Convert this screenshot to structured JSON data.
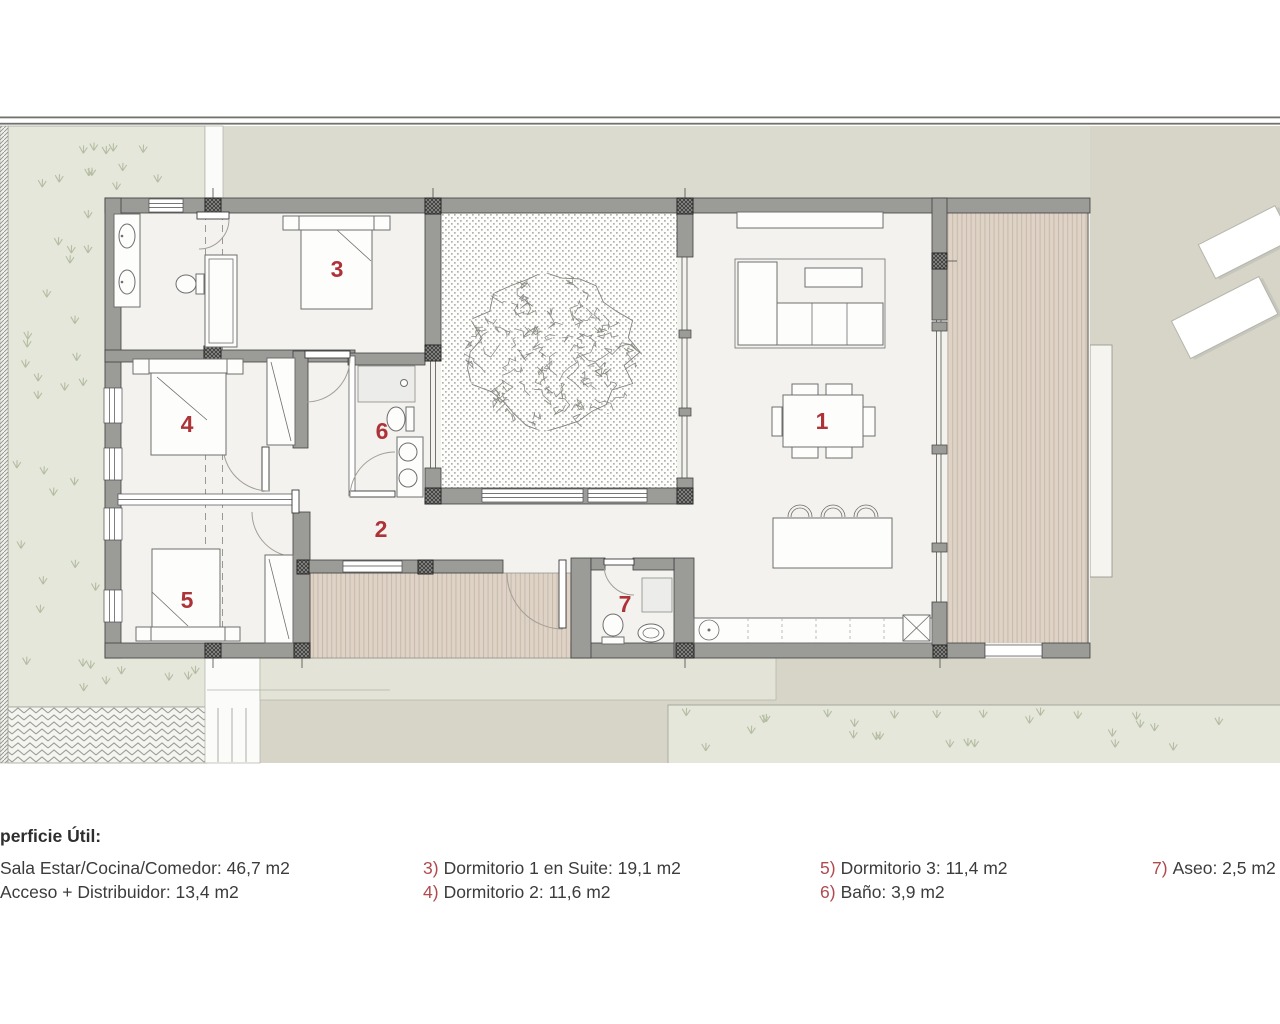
{
  "legend": {
    "title": "perficie Útil:",
    "items": [
      {
        "num": "",
        "text": "Sala Estar/Cocina/Comedor: 46,7 m2"
      },
      {
        "num": "",
        "text": "Acceso + Distribuidor: 13,4 m2"
      },
      {
        "num": "3)",
        "text": "Dormitorio 1 en Suite: 19,1 m2"
      },
      {
        "num": "4)",
        "text": "Dormitorio 2: 11,6 m2"
      },
      {
        "num": "5)",
        "text": "Dormitorio 3: 11,4 m2"
      },
      {
        "num": "6)",
        "text": "Baño: 3,9 m2"
      },
      {
        "num": "7)",
        "text": "Aseo: 2,5 m2"
      }
    ]
  },
  "plan": {
    "room_labels": [
      {
        "id": "sala-estar-cocina-comedor",
        "label": "1"
      },
      {
        "id": "distribuidor",
        "label": "2"
      },
      {
        "id": "dormitorio-1-en-suite",
        "label": "3"
      },
      {
        "id": "dormitorio-2",
        "label": "4"
      },
      {
        "id": "dormitorio-3",
        "label": "5"
      },
      {
        "id": "bano",
        "label": "6"
      },
      {
        "id": "aseo",
        "label": "7"
      }
    ],
    "colors": {
      "room_label_red": "#ae3338",
      "legend_number_red": "#b04a4e",
      "legend_text": "#3c3c3c",
      "site_beige": "#d6d5c7",
      "upper_band": "#dcdbd0",
      "grass_green": "#e5e7da",
      "wall_gray": "#9b9b98",
      "interior_floor": "#f3f2ef",
      "wood_deck": "#ded3c6",
      "courtyard_white": "#fdfdfb"
    }
  }
}
